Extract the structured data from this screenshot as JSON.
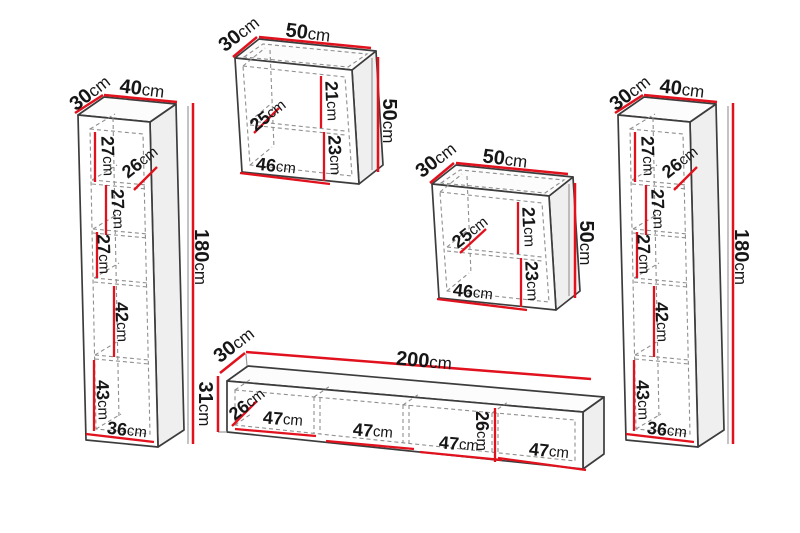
{
  "colors": {
    "dimension_red": "#e1121e",
    "outline_dark": "#3c3c3c",
    "dashed_gray": "#8f8f8f",
    "text": "#161616",
    "background": "#ffffff"
  },
  "pieces": {
    "leftColumn": {
      "depth": {
        "v": "30",
        "u": "cm"
      },
      "width": {
        "v": "40",
        "u": "cm"
      },
      "height": {
        "v": "180",
        "u": "cm"
      },
      "inner": {
        "shelf1": {
          "v": "27",
          "u": "cm"
        },
        "innerDepth": {
          "v": "26",
          "u": "cm"
        },
        "shelf2": {
          "v": "27",
          "u": "cm"
        },
        "shelf3": {
          "v": "27",
          "u": "cm"
        },
        "shelf4": {
          "v": "42",
          "u": "cm"
        },
        "shelf5": {
          "v": "43",
          "u": "cm"
        },
        "innerWidth": {
          "v": "36",
          "u": "cm"
        }
      }
    },
    "wallCabinetTop": {
      "depth": {
        "v": "30",
        "u": "cm"
      },
      "width": {
        "v": "50",
        "u": "cm"
      },
      "height": {
        "v": "50",
        "u": "cm"
      },
      "inner": {
        "innerDepth": {
          "v": "25",
          "u": "cm"
        },
        "upperSection": {
          "v": "21",
          "u": "cm"
        },
        "lowerSection": {
          "v": "23",
          "u": "cm"
        },
        "innerWidth": {
          "v": "46",
          "u": "cm"
        }
      }
    },
    "wallCabinetMiddle": {
      "depth": {
        "v": "30",
        "u": "cm"
      },
      "width": {
        "v": "50",
        "u": "cm"
      },
      "height": {
        "v": "50",
        "u": "cm"
      },
      "inner": {
        "innerDepth": {
          "v": "25",
          "u": "cm"
        },
        "upperSection": {
          "v": "21",
          "u": "cm"
        },
        "lowerSection": {
          "v": "23",
          "u": "cm"
        },
        "innerWidth": {
          "v": "46",
          "u": "cm"
        }
      }
    },
    "rightColumn": {
      "depth": {
        "v": "30",
        "u": "cm"
      },
      "width": {
        "v": "40",
        "u": "cm"
      },
      "height": {
        "v": "180",
        "u": "cm"
      },
      "inner": {
        "shelf1": {
          "v": "27",
          "u": "cm"
        },
        "innerDepth": {
          "v": "26",
          "u": "cm"
        },
        "shelf2": {
          "v": "27",
          "u": "cm"
        },
        "shelf3": {
          "v": "27",
          "u": "cm"
        },
        "shelf4": {
          "v": "42",
          "u": "cm"
        },
        "shelf5": {
          "v": "43",
          "u": "cm"
        },
        "innerWidth": {
          "v": "36",
          "u": "cm"
        }
      }
    },
    "tvStand": {
      "depth": {
        "v": "30",
        "u": "cm"
      },
      "width": {
        "v": "200",
        "u": "cm"
      },
      "height": {
        "v": "31",
        "u": "cm"
      },
      "inner": {
        "innerDepth": {
          "v": "26",
          "u": "cm"
        },
        "comp1": {
          "v": "47",
          "u": "cm"
        },
        "comp2": {
          "v": "47",
          "u": "cm"
        },
        "comp3": {
          "v": "47",
          "u": "cm"
        },
        "innerHeight": {
          "v": "26",
          "u": "cm"
        },
        "comp4": {
          "v": "47",
          "u": "cm"
        }
      }
    }
  }
}
